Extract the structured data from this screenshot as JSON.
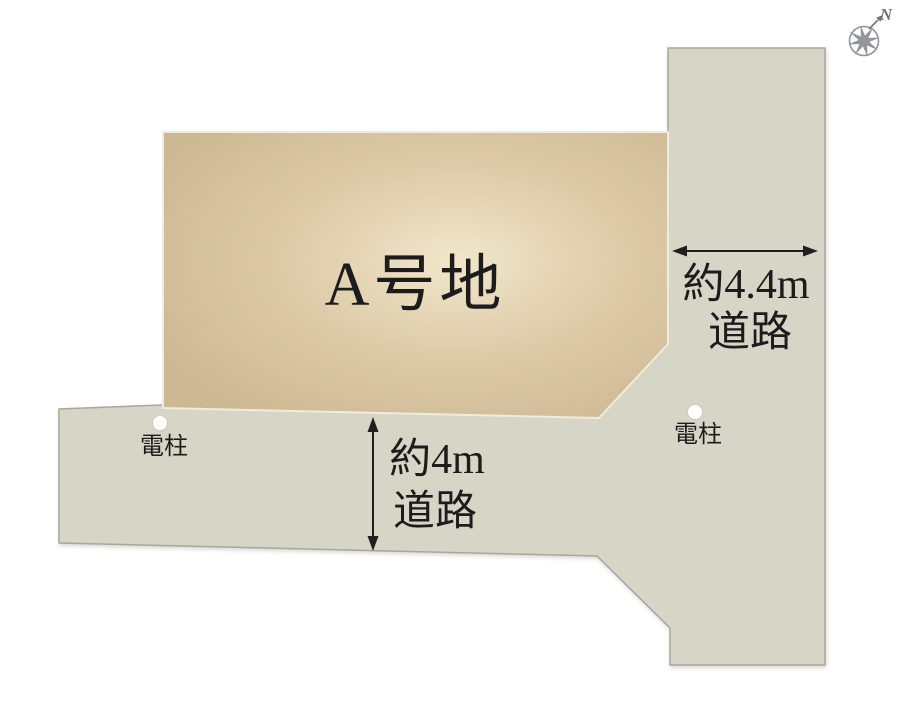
{
  "diagram": {
    "lot": {
      "label": "A号地"
    },
    "road_vertical": {
      "width_label": "約4.4m",
      "type_label": "道路"
    },
    "road_horizontal": {
      "width_label": "約4m",
      "type_label": "道路"
    },
    "poles": {
      "left_label": "電柱",
      "right_label": "電柱"
    },
    "compass": {
      "north_label": "N"
    }
  },
  "colors": {
    "background": "#ffffff",
    "road_fill": "#d7d5c6",
    "road_stroke": "#a9a79b",
    "lot_center": "#f1e6cb",
    "lot_mid": "#ddcaa7",
    "lot_edge": "#ccb893",
    "lot_stroke": "#f0ebdc",
    "text": "#1c1c1c",
    "arrow": "#1f1f1f",
    "pole_fill": "#ffffff",
    "pole_stroke": "#c9c7ba",
    "compass": "#93959d",
    "compass_dark": "#70747f"
  }
}
